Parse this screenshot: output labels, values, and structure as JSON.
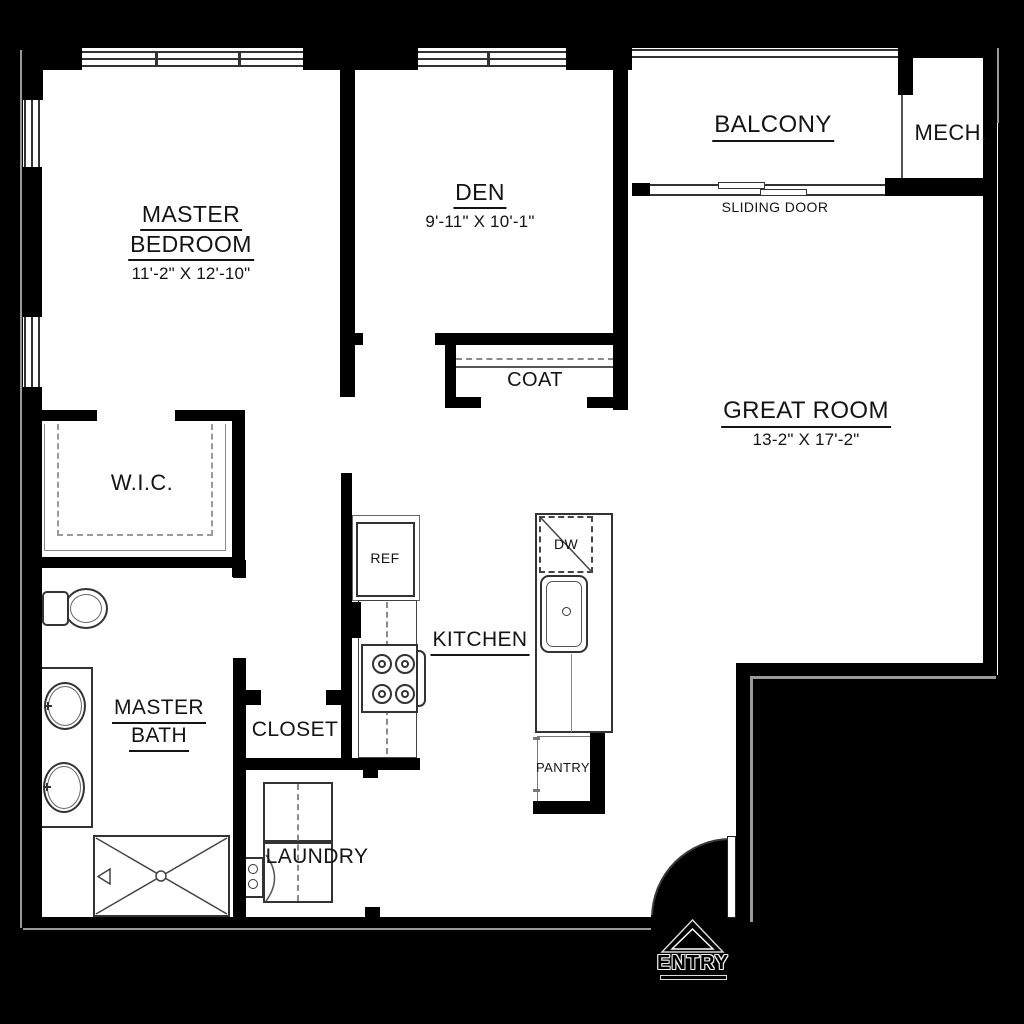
{
  "plan_title": "Floor Plan",
  "rooms": {
    "master_bedroom": {
      "line1": "MASTER",
      "line2": "BEDROOM",
      "dims": "11'-2\" X 12'-10\""
    },
    "den": {
      "label": "DEN",
      "dims": "9'-11\" X 10'-1\""
    },
    "balcony": {
      "label": "BALCONY"
    },
    "mech": {
      "label": "MECH."
    },
    "great_room": {
      "label": "GREAT ROOM",
      "dims": "13-2\" X 17'-2\""
    },
    "coat": {
      "label": "COAT"
    },
    "wic": {
      "label": "W.I.C."
    },
    "kitchen": {
      "label": "KITCHEN"
    },
    "master_bath": {
      "line1": "MASTER",
      "line2": "BATH"
    },
    "closet": {
      "label": "CLOSET"
    },
    "laundry": {
      "label": "LAUNDRY"
    },
    "pantry": {
      "label": "PANTRY"
    },
    "entry": {
      "label": "ENTRY"
    }
  },
  "fixtures": {
    "refrigerator": {
      "label": "REF"
    },
    "dishwasher": {
      "label": "DW"
    },
    "sliding_door": {
      "label": "SLIDING DOOR"
    }
  },
  "colors": {
    "wall": "#000000",
    "floor": "#ffffff",
    "background": "#000000",
    "line": "#333333",
    "text": "#141414"
  }
}
